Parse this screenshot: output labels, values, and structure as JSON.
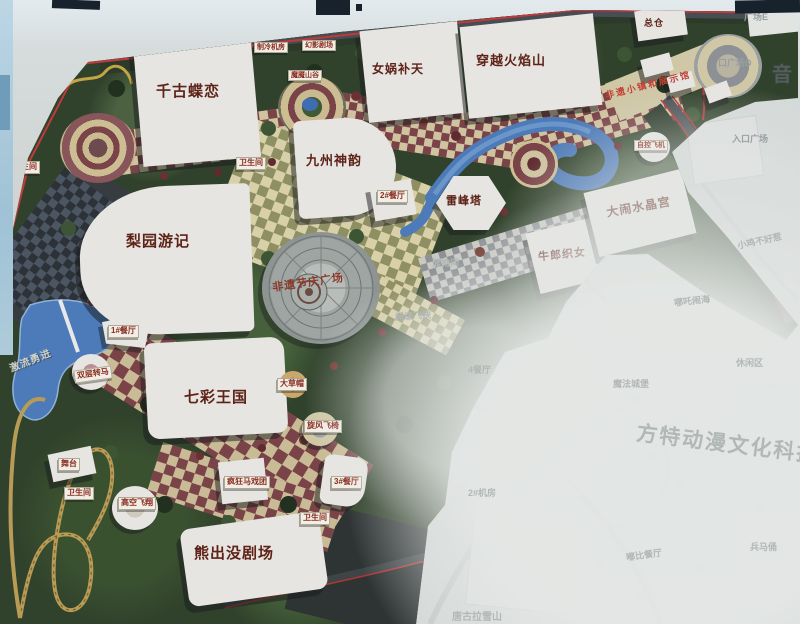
{
  "colors": {
    "tile_maroon": "#7a4348",
    "tile_cream": "#cfc3a0",
    "water": "#4d7ab8",
    "map_red": "#b23636",
    "foliage_green": "#31422c",
    "label_red": "#5e2318",
    "faded_text": "#b2b8b7"
  },
  "map": {
    "attractions": {
      "qiangu": "千古蝶恋",
      "nvwa": "女娲补天",
      "chuanyue": "穿越火焰山",
      "jiuzhou": "九州神韵",
      "liyuan": "梨园游记",
      "leifengta": "雷峰塔",
      "niulang": "牛郎织女",
      "danao": "大闹水晶宫",
      "qicai": "七彩王国",
      "xiongchumo": "熊出没剧场",
      "plaza": "非遗节庆广场",
      "town": "非遗小镇和展示馆",
      "jiliu": "激流勇进",
      "shuangceng": "双层转马",
      "gaokong": "高空飞翔",
      "fengkuang": "疯狂马戏团",
      "xuanfeng": "旋风飞椅",
      "dacaomao": "大草帽",
      "wutai": "舞台",
      "zikong": "自控飞机",
      "moyan": "魔魇山谷",
      "huanying": "幻影剧场"
    },
    "facilities": {
      "rest1": "1#餐厅",
      "rest2": "2#餐厅",
      "rest3": "3#餐厅",
      "toilet": "卫生间",
      "zongcang": "总仓",
      "zhileng": "制冷机房"
    },
    "entrances": {
      "plaza_e": "广场E",
      "plaza_d": "口广场D",
      "entrance_plaza": "入口广场",
      "yin": "音"
    },
    "faded": {
      "watermark": "方特动漫文化科技",
      "xiaoji": "小鸡不好惹",
      "nezha": "哪吒闹海",
      "xiuxian": "休闲区",
      "mofa": "魔法城堡",
      "bingma": "兵马俑",
      "tanggula": "唐古拉雪山",
      "dubi": "嘟比餐厅",
      "jifang2": "2#机房",
      "rest4": "4餐厅",
      "chaoji": "超级飞侠",
      "chuwu": "储物间"
    }
  }
}
